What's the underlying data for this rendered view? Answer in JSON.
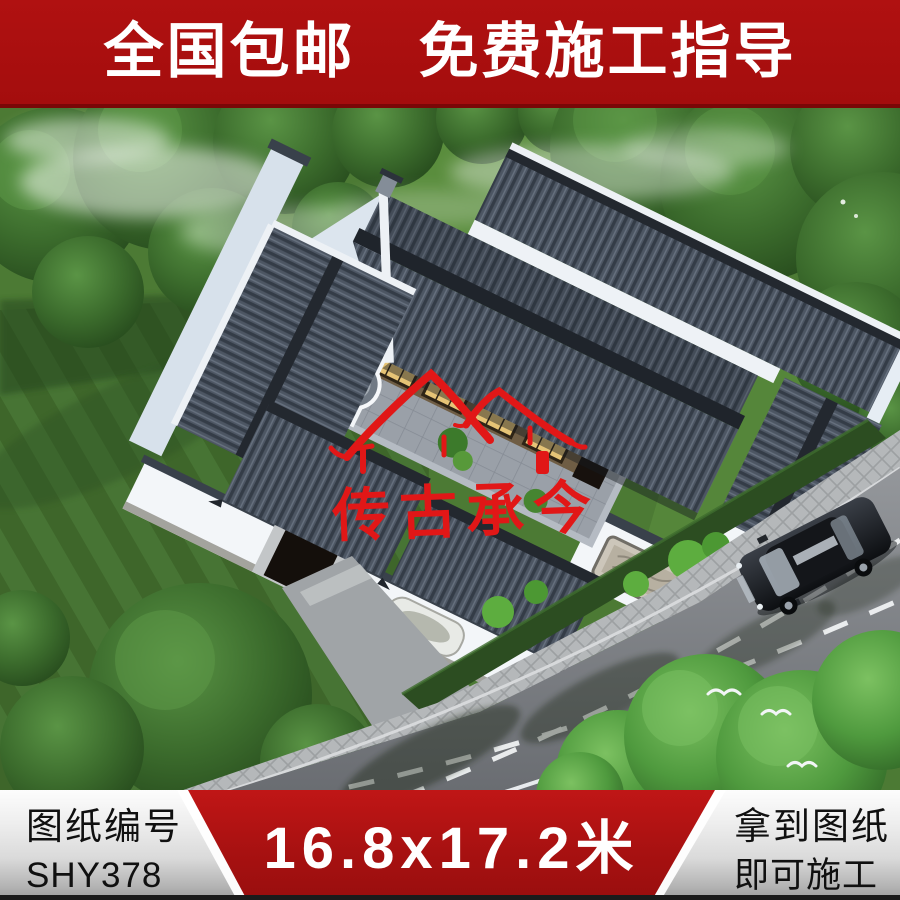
{
  "top_banner": {
    "text": "全国包邮　免费施工指导",
    "bg": "#a40d0d",
    "text_color": "#ffffff"
  },
  "photo": {
    "watermark": {
      "text": "传古承今",
      "color": "#e11717",
      "logo": "double-eave-roof-emblem"
    },
    "scene": {
      "subject": "chinese-courtyard-house-aerial-render",
      "roof_color": "#4d5663",
      "wall_color": "#f3f6f9",
      "lawn_color": "#4c7a34",
      "road_color": "#8d9094",
      "car": "black-sedan",
      "birds": "white-birds"
    }
  },
  "bottom_banner": {
    "left": {
      "label": "图纸编号",
      "code": "SHY378"
    },
    "center": {
      "dimensions": "16.8x17.2米",
      "bg": "#a81111"
    },
    "right": {
      "line1": "拿到图纸",
      "line2": "即可施工"
    }
  }
}
